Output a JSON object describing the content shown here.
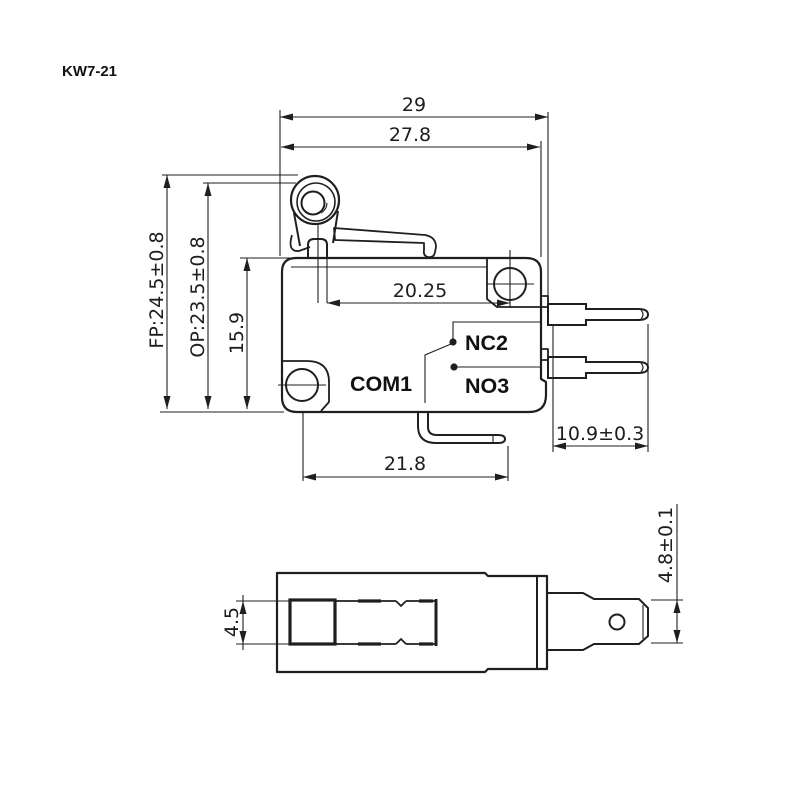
{
  "title": "KW7-21",
  "views": {
    "front": {
      "dims": {
        "total_width": "29",
        "body_width": "27.8",
        "plunger_to_hole": "20.25",
        "free_position": "FP:24.5±0.8",
        "operating_position": "OP:23.5±0.8",
        "body_height": "15.9",
        "terminal_length": "10.9±0.3",
        "com_terminal_span": "21.8"
      },
      "labels": {
        "com": "COM1",
        "nc": "NC2",
        "no": "NO3"
      }
    },
    "bottom": {
      "dims": {
        "plunger_width": "4.5",
        "terminal_width": "4.8±0.1"
      }
    }
  },
  "colors": {
    "line": "#1f1f1f",
    "background": "#ffffff"
  }
}
